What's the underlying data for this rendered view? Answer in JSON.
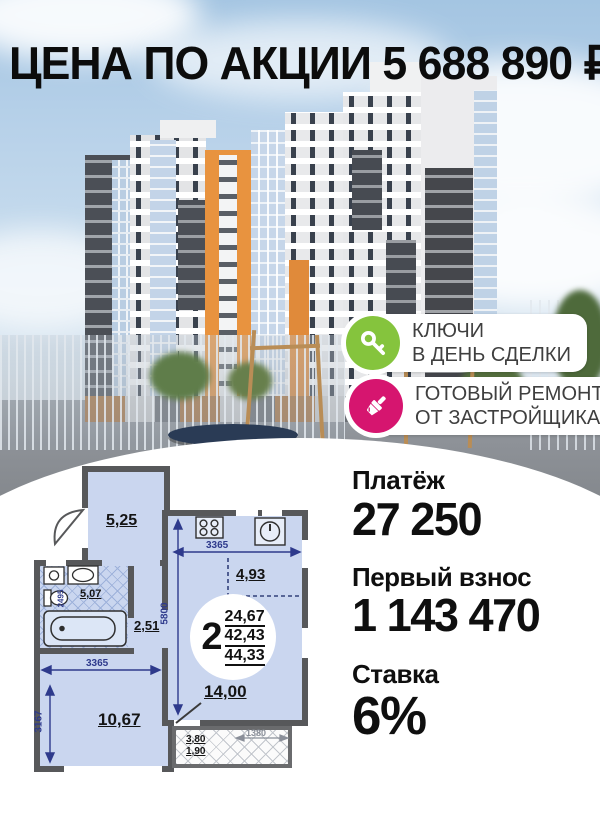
{
  "header": {
    "title": "ЦЕНА ПО АКЦИИ 5 688 890 ₽"
  },
  "badges": [
    {
      "icon": "key-icon",
      "color": "#85c43d",
      "line1": "КЛЮЧИ",
      "line2": "В ДЕНЬ СДЕЛКИ"
    },
    {
      "icon": "brush-icon",
      "color": "#d6156f",
      "line1": "ГОТОВЫЙ РЕМОНТ",
      "line2": "ОТ ЗАСТРОЙЩИКА"
    }
  ],
  "payments": [
    {
      "label": "Платёж",
      "value": "27 250"
    },
    {
      "label": "Первый взнос",
      "value": "1 143 470"
    },
    {
      "label": "Ставка",
      "value": "6%"
    }
  ],
  "floorplan": {
    "rooms": {
      "hall": "5,25",
      "bathroom": "5,07",
      "corridor": "2,51",
      "bedroom": "10,67",
      "kitchen": "14,00",
      "niche": "4,93"
    },
    "summary": {
      "rooms_count": "2",
      "living_area": "24,67",
      "apartment_area": "42,43",
      "total_area": "44,33"
    },
    "dims": {
      "kitchen_width": "3365",
      "kitchen_height": "5800",
      "bedroom_width": "3365",
      "bedroom_height": "3167",
      "bath_height": "2495",
      "balcony_width": "1380",
      "balcony_area_full": "3,80",
      "balcony_area_half": "1,90"
    }
  },
  "colors": {
    "wall": "#57585a",
    "room_fill": "#cad6ef",
    "dim_blue": "#2e3a8c"
  }
}
